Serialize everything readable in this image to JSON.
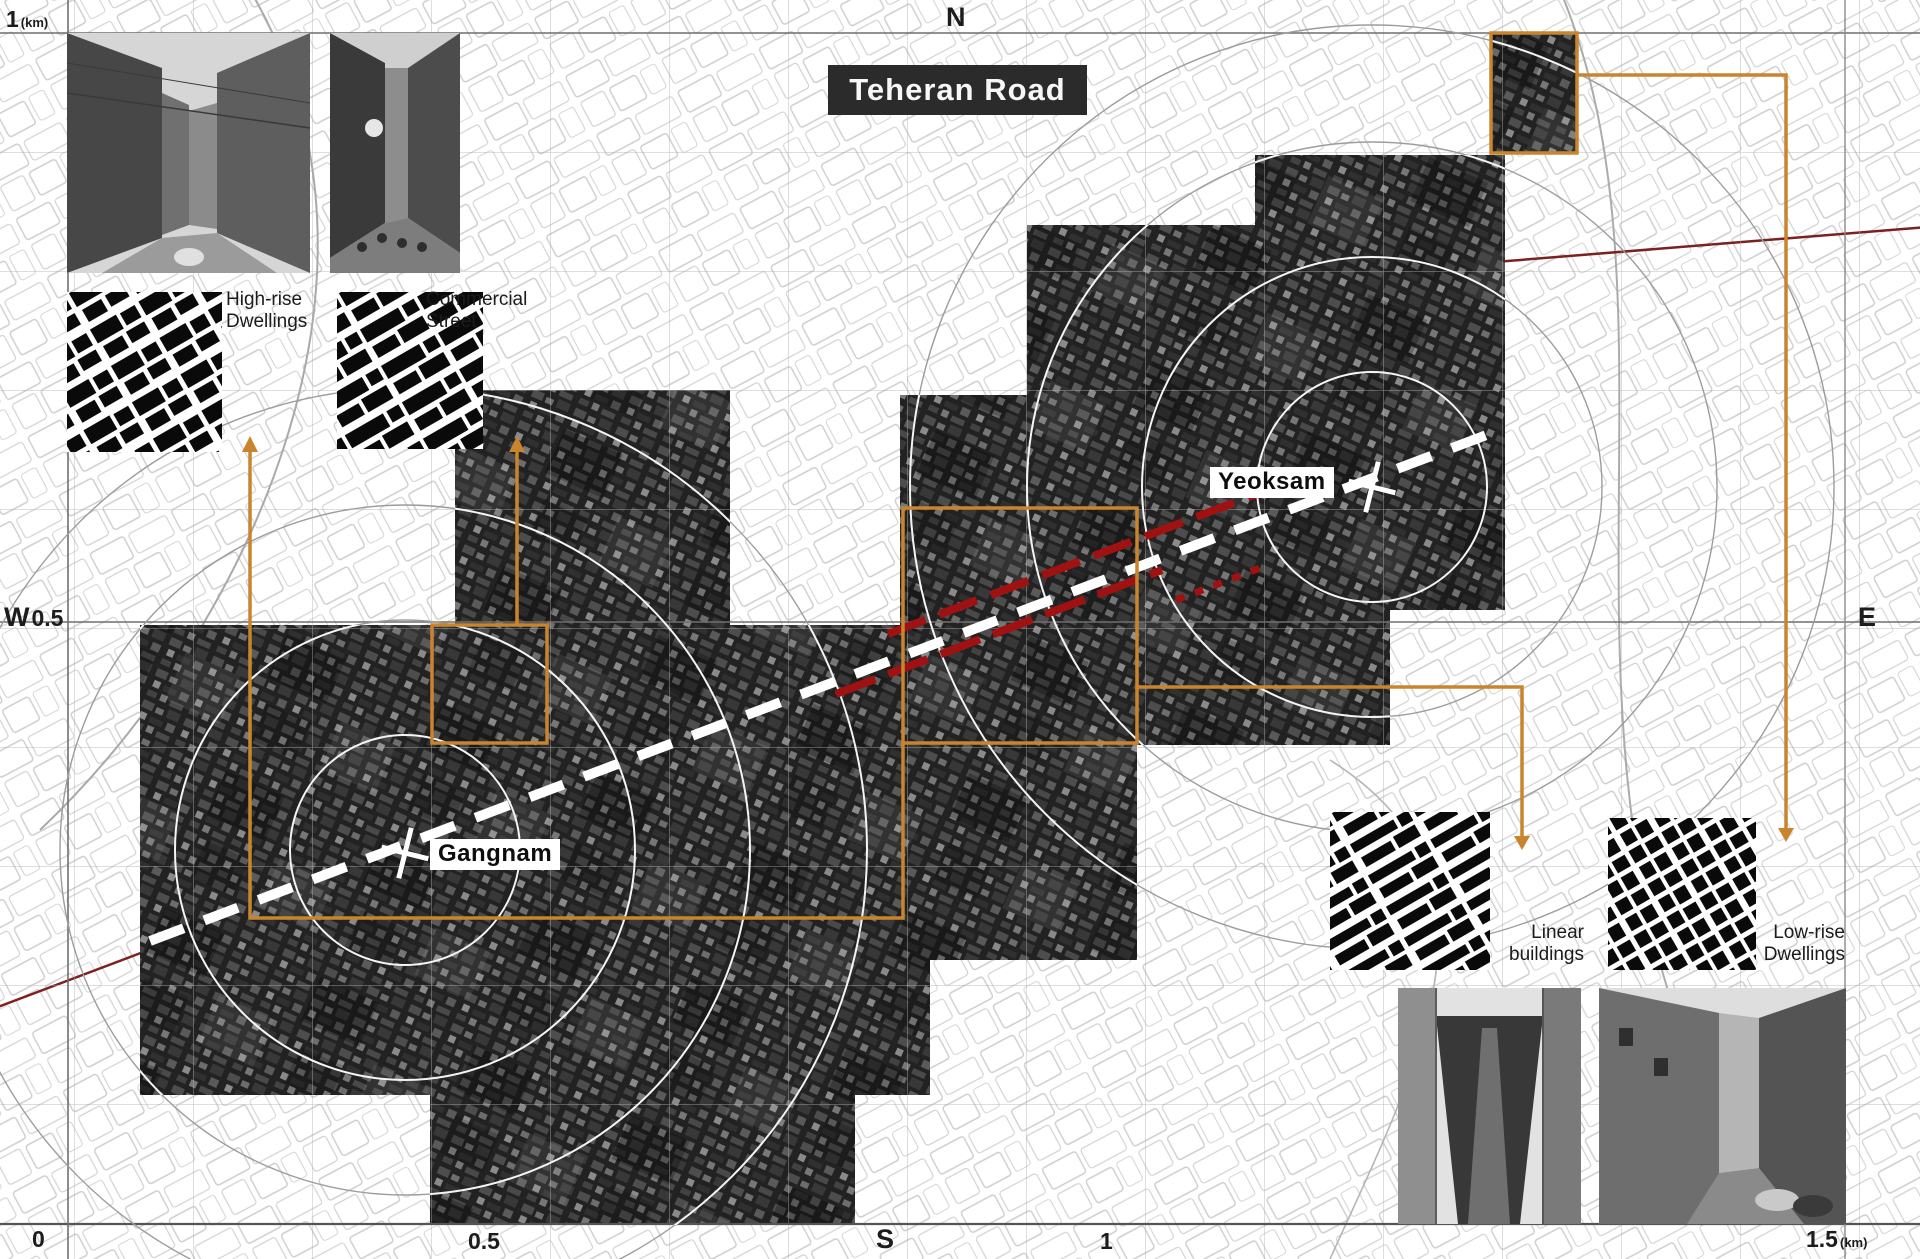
{
  "title": {
    "text": "Teheran Road"
  },
  "compass": {
    "north": "N",
    "south": "S",
    "east": "E",
    "west": "W"
  },
  "scale_marks": {
    "top_left": {
      "value": "1",
      "unit": "(km)"
    },
    "left_value": "0.5",
    "bottom_zero": "0",
    "bottom_half": "0.5",
    "bottom_one": "1",
    "bottom_right": {
      "value": "1.5",
      "unit": "(km)"
    }
  },
  "stations": [
    {
      "name": "Gangnam"
    },
    {
      "name": "Yeoksam"
    }
  ],
  "typologies": [
    {
      "line1": "High-rise",
      "line2": "Dwellings"
    },
    {
      "line1": "Commercial",
      "line2": "Street"
    },
    {
      "line1": "Linear",
      "line2": "buildings"
    },
    {
      "line1": "Low-rise",
      "line2": "Dwellings"
    }
  ],
  "colors": {
    "highlight_orange": "#c9852e",
    "title_background": "#2b2b2b",
    "road_dash": "#ffffff",
    "red_dash": "#a01212",
    "dark_red_line": "#7c2020"
  }
}
